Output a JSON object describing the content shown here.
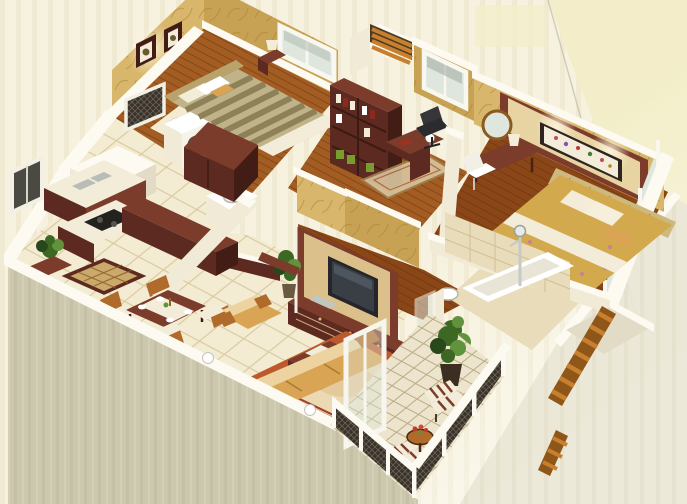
{
  "scene": {
    "label": "3D isometric cutaway floor plan render of a three-room apartment",
    "style": "photorealistic architectural render",
    "view": "isometric cutaway, walls sliced white on top"
  },
  "rooms": [
    {
      "id": "bedroom-2",
      "label": "Second bedroom",
      "floor": "wood",
      "furniture": [
        "striped double bed",
        "ornate headboard",
        "two framed pictures",
        "window",
        "nightstand with lamp",
        "maroon wardrobe"
      ]
    },
    {
      "id": "study",
      "label": "Study",
      "floor": "wood",
      "furniture": [
        "maroon bookshelf with books and green boxes",
        "desk with lamp",
        "black office chair",
        "oriental rug",
        "window",
        "wallpapered half wall"
      ]
    },
    {
      "id": "master-bedroom",
      "label": "Master bedroom",
      "floor": "wood",
      "furniture": [
        "feature headboard wall with framed floral artwork",
        "rattan headboard",
        "floral double bed",
        "nightstand with lamp",
        "dressing table",
        "round mirror",
        "white chair",
        "window wall"
      ]
    },
    {
      "id": "kitchen",
      "label": "Kitchen",
      "floor": "tile",
      "furniture": [
        "sink counter",
        "cooktop counter",
        "maroon island cabinet"
      ]
    },
    {
      "id": "utility",
      "label": "Utility / laundry",
      "floor": "tile",
      "furniture": [
        "washing machine",
        "lattice screen",
        "floor lamp",
        "dark window"
      ]
    },
    {
      "id": "bathroom",
      "label": "Bathroom",
      "floor": "tile",
      "furniture": [
        "white vanity with sink",
        "maroon half wall"
      ]
    },
    {
      "id": "ensuite-bathroom",
      "label": "Ensuite bathroom",
      "floor": "tile",
      "furniture": [
        "tiled wall",
        "bathtub",
        "shower column",
        "sink",
        "glass partition"
      ]
    },
    {
      "id": "hallway",
      "label": "Hallway",
      "floor": "wood",
      "furniture": []
    },
    {
      "id": "entry",
      "label": "Entry",
      "floor": "tile",
      "furniture": [
        "maroon console",
        "potted plant",
        "patterned door mat"
      ]
    },
    {
      "id": "dining",
      "label": "Dining area",
      "floor": "tile",
      "furniture": [
        "maroon dining table with runner",
        "four chairs",
        "place settings",
        "centerpiece"
      ]
    },
    {
      "id": "living-room",
      "label": "Living room",
      "floor": "tile",
      "furniture": [
        "TV feature wall",
        "flat television",
        "media cabinet",
        "gold sofa",
        "two gold armchairs",
        "maroon coffee table with runner and bowl",
        "bordered area rug",
        "two potted plants",
        "two sphere lamps on parapet"
      ]
    },
    {
      "id": "balcony",
      "label": "Balcony",
      "floor": "diamond tile",
      "furniture": [
        "two striped armchairs",
        "round wood table with red flowers",
        "tall potted plant",
        "lattice railing with white posts",
        "glass balcony door"
      ]
    },
    {
      "id": "ac-ledge",
      "label": "Louvered service ledge",
      "floor": "tile",
      "furniture": [
        "orange wood louvers"
      ]
    }
  ],
  "palette": {
    "bg": "#f7f2df",
    "bgStripe": "#ece4c6",
    "bgCorner": "#f3eec9",
    "edgeLine": "#b9b6a6",
    "wallTop": "#fcfaf1",
    "wallLight": "#f0ead7",
    "wallMed": "#e2dbc5",
    "wallShadow": "#cfc7ad",
    "exteriorWall": "#ccc8ae",
    "exteriorStripe": "#bfbb9f",
    "rightFace": "#eae6d5",
    "rightStripe": "#dcd7c2",
    "wallpaper": "#d8b76d",
    "wallpaperDark": "#c8a254",
    "wallpaperLeaf": "#ad8636",
    "woodFloor": "#a35d23",
    "woodFloorDark": "#8a4617",
    "woodPlank": "#6f3710",
    "tileFloor": "#f4ecd2",
    "tileLine": "#d8cba2",
    "bathTile": "#e9dcba",
    "maroon": "#5c2a20",
    "maroonLight": "#7c3c2c",
    "maroonDark": "#421d15",
    "gold": "#d9a453",
    "goldLight": "#edd3a0",
    "woodTrim": "#b06a2a",
    "rugBorder": "#bc5a2e",
    "rugField": "#ecd9b4",
    "rugAccent": "#a43b22",
    "oliveA": "#8e8157",
    "oliveB": "#c0b38a",
    "cream": "#f3ecd9",
    "white": "#ffffff",
    "floral": "#d3a94e",
    "floralPink": "#c97f97",
    "green": "#3c6824",
    "greenDark": "#27481a",
    "greenLight": "#61923c",
    "louver": "#c8802f",
    "louverDark": "#8e5618",
    "railing": "#39322a",
    "railingLight": "#8d8371",
    "glassCol": "#dfe6dd",
    "glassFrame": "#f6f6ef",
    "tvBlack": "#26262a",
    "tvScreen": "#3a3f46",
    "chrome": "#c6cac6",
    "darkWindow": "#4a4a42",
    "headboardTan": "#b9a36b",
    "rattan": "#cdb87e",
    "bookRed": "#8a2a1e",
    "boxGreen": "#7a9c2e"
  }
}
